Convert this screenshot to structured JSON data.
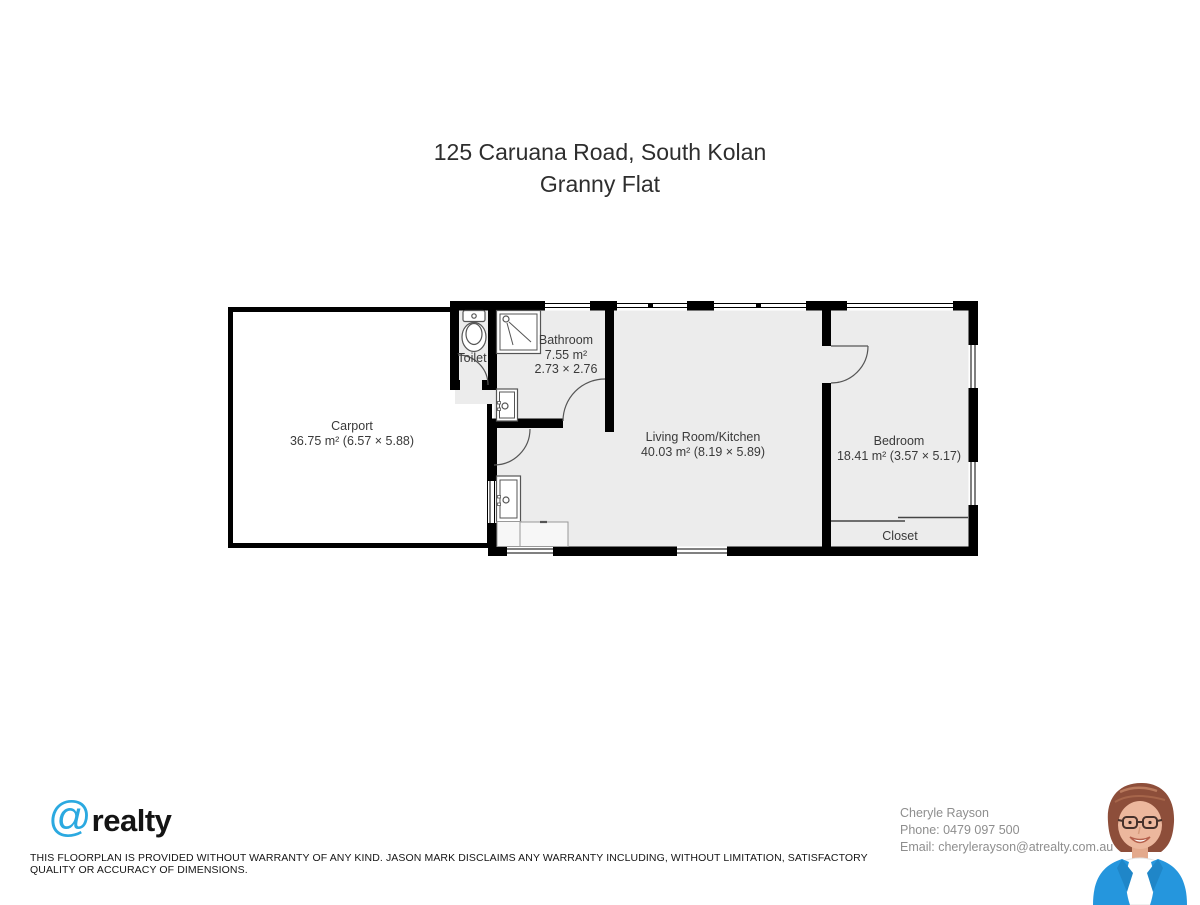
{
  "title": {
    "line1": "125 Caruana Road, South Kolan",
    "line2": "Granny Flat"
  },
  "floorplan": {
    "rooms": {
      "carport": {
        "name": "Carport",
        "area": "36.75 m² (6.57 × 5.88)"
      },
      "toilet": {
        "name": "Toilet"
      },
      "bathroom": {
        "name": "Bathroom",
        "area": "7.55 m²",
        "dims": "2.73 × 2.76"
      },
      "living": {
        "name": "Living Room/Kitchen",
        "area": "40.03 m² (8.19 × 5.89)"
      },
      "bedroom": {
        "name": "Bedroom",
        "area": "18.41 m² (3.57 × 5.17)"
      },
      "closet": {
        "name": "Closet"
      }
    },
    "colors": {
      "wall": "#000000",
      "room_fill": "#ececec",
      "carport_fill": "#ffffff",
      "fixture_stroke": "#555555"
    },
    "icons": [
      "toilet-icon",
      "shower-icon",
      "vanity-sink-icon",
      "kitchen-sink-icon"
    ]
  },
  "footer": {
    "logo": {
      "at": "@",
      "name": "realty",
      "accent": "#2BA9E0"
    },
    "agent": {
      "name": "Cheryle Rayson",
      "phone": "Phone: 0479 097 500",
      "email": "Email: cherylerayson@atrealty.com.au"
    },
    "disclaimer": "THIS FLOORPLAN IS PROVIDED WITHOUT WARRANTY OF ANY KIND. JASON MARK DISCLAIMS ANY WARRANTY INCLUDING, WITHOUT LIMITATION, SATISFACTORY QUALITY OR ACCURACY OF DIMENSIONS."
  }
}
